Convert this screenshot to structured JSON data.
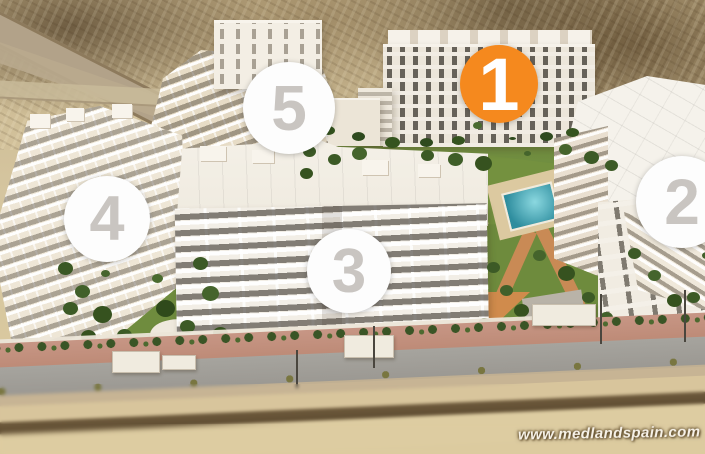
{
  "scene": {
    "description": "Aerial 3D render of a residential apartment complex with five numbered phase markers",
    "watermark": "www.medlandspain.com"
  },
  "markers": [
    {
      "id": "phase-1",
      "label": "1",
      "state": "highlighted"
    },
    {
      "id": "phase-2",
      "label": "2",
      "state": "default"
    },
    {
      "id": "phase-3",
      "label": "3",
      "state": "default"
    },
    {
      "id": "phase-4",
      "label": "4",
      "state": "default"
    },
    {
      "id": "phase-5",
      "label": "5",
      "state": "default"
    }
  ],
  "colors": {
    "marker_highlight_bg": "#F5891E",
    "marker_highlight_number": "#FFFFFF",
    "marker_default_bg": "#FDFDFD",
    "marker_default_number": "#C9C5C1"
  }
}
